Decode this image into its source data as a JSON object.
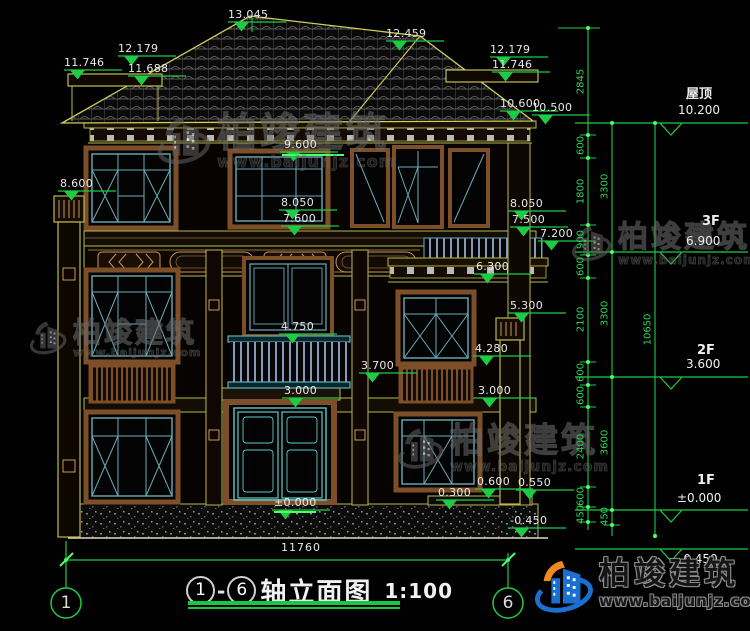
{
  "brand": {
    "name": "柏竣建筑",
    "url": "www.baijunjz.com"
  },
  "title_block": {
    "axis_from": "1",
    "axis_to": "6",
    "title": "轴立面图",
    "scale": "1:100"
  },
  "axis_bubbles": {
    "left": "1",
    "right": "6"
  },
  "bottom_dim": {
    "t": "11760"
  },
  "spot_elevations": [
    {
      "t": "13.045",
      "x": 228,
      "y": 8
    },
    {
      "t": "12.459",
      "x": 386,
      "y": 27
    },
    {
      "t": "12.179",
      "x": 118,
      "y": 42
    },
    {
      "t": "11.746",
      "x": 64,
      "y": 56
    },
    {
      "t": "11.688",
      "x": 128,
      "y": 62
    },
    {
      "t": "12.179",
      "x": 490,
      "y": 43
    },
    {
      "t": "11.746",
      "x": 492,
      "y": 58
    },
    {
      "t": "10.600",
      "x": 500,
      "y": 97
    },
    {
      "t": "10.500",
      "x": 532,
      "y": 101
    },
    {
      "t": "9.600",
      "x": 284,
      "y": 138
    },
    {
      "t": "8.600",
      "x": 60,
      "y": 177
    },
    {
      "t": "8.050",
      "x": 281,
      "y": 196
    },
    {
      "t": "7.600",
      "x": 283,
      "y": 212
    },
    {
      "t": "8.050",
      "x": 510,
      "y": 197
    },
    {
      "t": "7.500",
      "x": 512,
      "y": 213
    },
    {
      "t": "7.200",
      "x": 540,
      "y": 227
    },
    {
      "t": "6.300",
      "x": 476,
      "y": 260
    },
    {
      "t": "5.300",
      "x": 510,
      "y": 299
    },
    {
      "t": "4.750",
      "x": 281,
      "y": 320
    },
    {
      "t": "4.280",
      "x": 475,
      "y": 342
    },
    {
      "t": "3.700",
      "x": 361,
      "y": 359
    },
    {
      "t": "3.000",
      "x": 284,
      "y": 384
    },
    {
      "t": "3.000",
      "x": 478,
      "y": 384
    },
    {
      "t": "0.600",
      "x": 477,
      "y": 475
    },
    {
      "t": "0.550",
      "x": 518,
      "y": 476
    },
    {
      "t": "0.300",
      "x": 438,
      "y": 486
    },
    {
      "t": "±0.000",
      "x": 274,
      "y": 496
    },
    {
      "t": "-0.450",
      "x": 510,
      "y": 514
    }
  ],
  "floor_labels": [
    {
      "t": "屋顶",
      "x": 686,
      "y": 83,
      "big": true
    },
    {
      "t": "10.200",
      "x": 678,
      "y": 103
    },
    {
      "t": "3F",
      "x": 702,
      "y": 214,
      "big": true
    },
    {
      "t": "6.900",
      "x": 686,
      "y": 234
    },
    {
      "t": "2F",
      "x": 697,
      "y": 343,
      "big": true
    },
    {
      "t": "3.600",
      "x": 686,
      "y": 357
    },
    {
      "t": "1F",
      "x": 697,
      "y": 473,
      "big": true
    },
    {
      "t": "±0.000",
      "x": 677,
      "y": 491
    },
    {
      "t": "-0.450",
      "x": 679,
      "y": 552
    }
  ],
  "chain_dims": [
    {
      "t": "2845",
      "x": 581,
      "y": 82
    },
    {
      "t": "600",
      "x": 581,
      "y": 146
    },
    {
      "t": "1800",
      "x": 581,
      "y": 192
    },
    {
      "t": "900",
      "x": 581,
      "y": 240
    },
    {
      "t": "600",
      "x": 581,
      "y": 267
    },
    {
      "t": "2100",
      "x": 581,
      "y": 320
    },
    {
      "t": "600",
      "x": 581,
      "y": 373
    },
    {
      "t": "600",
      "x": 581,
      "y": 396
    },
    {
      "t": "2400",
      "x": 581,
      "y": 447
    },
    {
      "t": "600",
      "x": 581,
      "y": 497
    },
    {
      "t": "450",
      "x": 581,
      "y": 515
    },
    {
      "t": "3300",
      "x": 605,
      "y": 187
    },
    {
      "t": "3300",
      "x": 605,
      "y": 314
    },
    {
      "t": "3600",
      "x": 605,
      "y": 443
    },
    {
      "t": "450",
      "x": 605,
      "y": 517
    },
    {
      "t": "10650",
      "x": 648,
      "y": 330
    }
  ],
  "watermarks": [
    {
      "x": 155,
      "y": 112,
      "s": 1.0
    },
    {
      "x": 28,
      "y": 318,
      "s": 0.7
    },
    {
      "x": 570,
      "y": 222,
      "s": 0.75
    },
    {
      "x": 396,
      "y": 424,
      "s": 0.85
    }
  ]
}
